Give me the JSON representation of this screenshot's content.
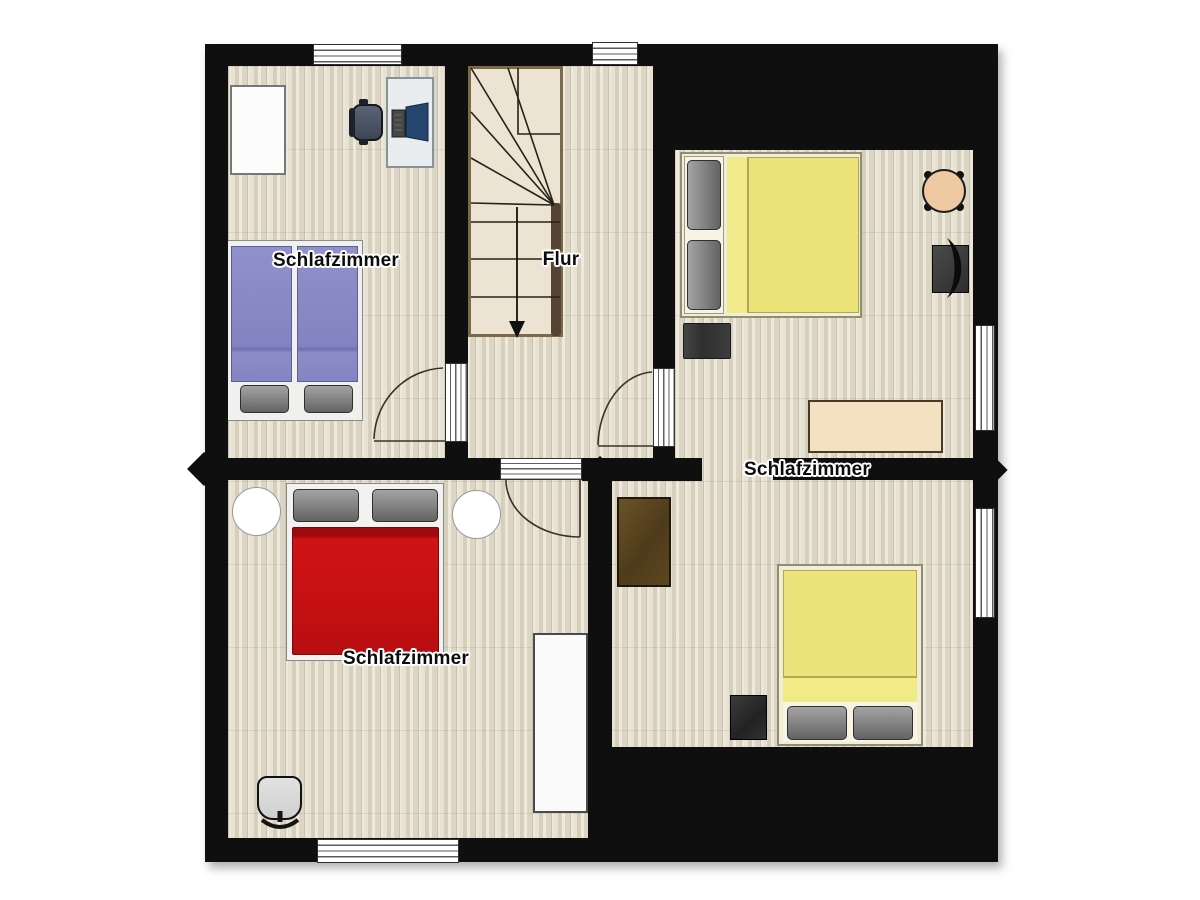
{
  "plan": {
    "type": "floor-plan",
    "labels": {
      "room_top_left": "Schlafzimmer",
      "hallway": "Flur",
      "room_right": "Schlafzimmer",
      "room_bottom_left": "Schlafzimmer"
    },
    "colors": {
      "wall": "#0f0f0f",
      "floor_base": "#e8e2d2",
      "stair_tread": "#ece3d2",
      "stair_trim": "#7d6847",
      "bed_blue": "#8585c2",
      "bed_red": "#c61013",
      "bed_yellow": "#ebe276",
      "bed_frame_cream": "#f2edda",
      "pillow_gray": "#8c8c8c",
      "round_table_tan": "#eec9a1",
      "sideboard_tan": "#f4e1c1",
      "wardrobe_brown": "#5a4521",
      "wardrobe_white": "#fbfbfb",
      "desk_top": "#e9edf0",
      "monitor_screen": "#24466e"
    },
    "rooms": [
      {
        "id": "bedroom-top-left",
        "label": "Schlafzimmer",
        "furniture": [
          "white-wardrobe",
          "desk",
          "desk-chair",
          "computer-monitor",
          "double-bed-blue"
        ]
      },
      {
        "id": "hallway",
        "label": "Flur",
        "furniture": [
          "winder-staircase-down"
        ]
      },
      {
        "id": "bedroom-right-top",
        "label": "Schlafzimmer",
        "furniture": [
          "double-bed-yellow",
          "round-side-table",
          "vanity-with-chair",
          "dark-rug",
          "sideboard"
        ]
      },
      {
        "id": "bedroom-bottom-left",
        "label": "Schlafzimmer",
        "furniture": [
          "double-bed-red",
          "round-bedside-left",
          "round-bedside-right",
          "white-wardrobe",
          "office-chair"
        ]
      },
      {
        "id": "bedroom-right-bottom",
        "label": "",
        "furniture": [
          "brown-wardrobe",
          "double-bed-yellow",
          "nightstand"
        ]
      }
    ]
  }
}
